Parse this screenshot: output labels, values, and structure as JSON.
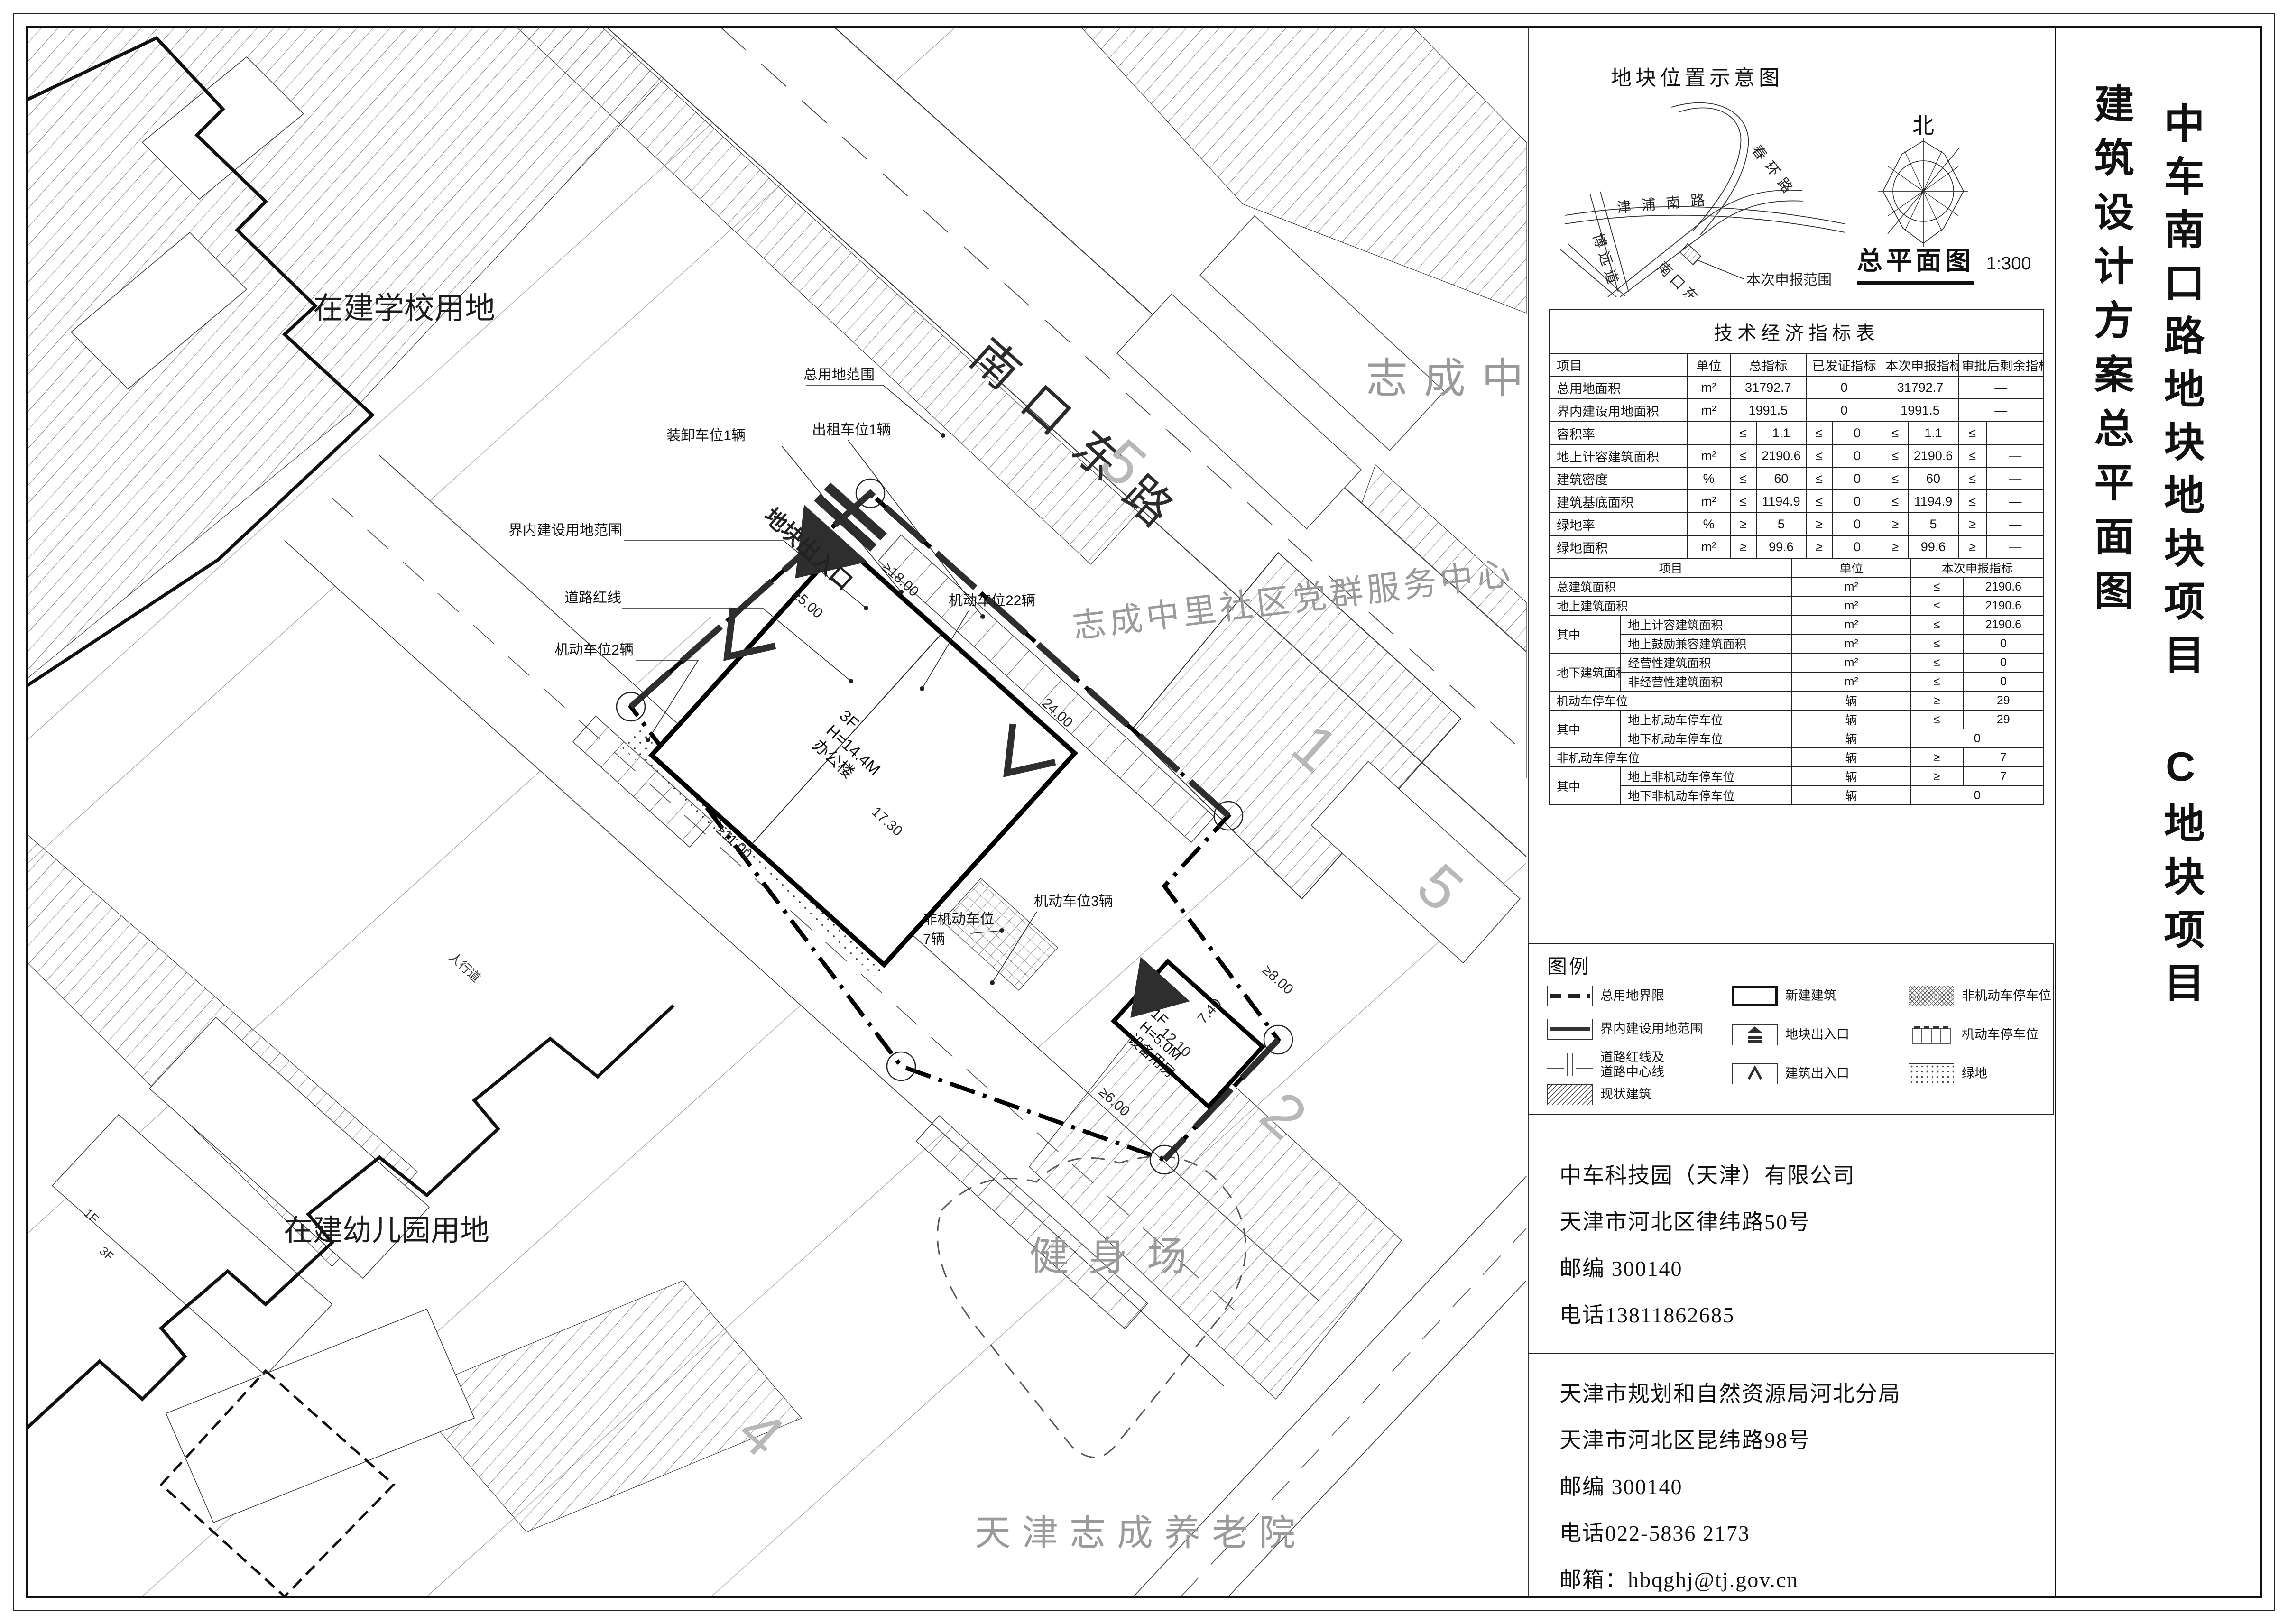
{
  "colors": {
    "line": "#1a1a1a",
    "gray_label": "#9a9a9a",
    "accent_dark": "#2e2e2e",
    "paper": "#ffffff"
  },
  "vertical_titles": {
    "project": "中车南口路地块地块项目 C地块项目",
    "drawing": "建筑设计方案总平面图"
  },
  "location_sketch": {
    "title": "地块位置示意图",
    "roads": [
      "春环路",
      "津浦南路",
      "博远道",
      "南口东路"
    ],
    "scope_label": "本次申报范围",
    "compass_north": "北",
    "plan_name": "总平面图",
    "plan_scale": "1:300"
  },
  "indicator_table": {
    "title": "技术经济指标表",
    "part1": {
      "header": [
        [
          "项目",
          1,
          1,
          "l h"
        ],
        [
          "单位"
        ],
        [
          "总指标",
          2
        ],
        [
          "已发证指标",
          2
        ],
        [
          "本次申报指标",
          2
        ],
        [
          "审批后剩余指标",
          2
        ]
      ],
      "rows": [
        [
          [
            "总用地面积",
            1,
            1,
            "l"
          ],
          [
            "m²"
          ],
          [
            "31792.7",
            2
          ],
          [
            "0",
            2
          ],
          [
            "31792.7",
            2
          ],
          [
            "—",
            2
          ]
        ],
        [
          [
            "界内建设用地面积",
            1,
            1,
            "l"
          ],
          [
            "m²"
          ],
          [
            "1991.5",
            2
          ],
          [
            "0",
            2
          ],
          [
            "1991.5",
            2
          ],
          [
            "—",
            2
          ]
        ],
        [
          [
            "容积率",
            1,
            1,
            "l"
          ],
          [
            "—"
          ],
          [
            "≤"
          ],
          [
            "1.1"
          ],
          [
            "≤"
          ],
          [
            "0"
          ],
          [
            "≤"
          ],
          [
            "1.1"
          ],
          [
            "≤"
          ],
          [
            "—"
          ]
        ],
        [
          [
            "地上计容建筑面积",
            1,
            1,
            "l"
          ],
          [
            "m²"
          ],
          [
            "≤"
          ],
          [
            "2190.6"
          ],
          [
            "≤"
          ],
          [
            "0"
          ],
          [
            "≤"
          ],
          [
            "2190.6"
          ],
          [
            "≤"
          ],
          [
            "—"
          ]
        ],
        [
          [
            "建筑密度",
            1,
            1,
            "l"
          ],
          [
            "%"
          ],
          [
            "≤"
          ],
          [
            "60"
          ],
          [
            "≤"
          ],
          [
            "0"
          ],
          [
            "≤"
          ],
          [
            "60"
          ],
          [
            "≤"
          ],
          [
            "—"
          ]
        ],
        [
          [
            "建筑基底面积",
            1,
            1,
            "l"
          ],
          [
            "m²"
          ],
          [
            "≤"
          ],
          [
            "1194.9"
          ],
          [
            "≤"
          ],
          [
            "0"
          ],
          [
            "≤"
          ],
          [
            "1194.9"
          ],
          [
            "≤"
          ],
          [
            "—"
          ]
        ],
        [
          [
            "绿地率",
            1,
            1,
            "l"
          ],
          [
            "%"
          ],
          [
            "≥"
          ],
          [
            "5"
          ],
          [
            "≥"
          ],
          [
            "0"
          ],
          [
            "≥"
          ],
          [
            "5"
          ],
          [
            "≥"
          ],
          [
            "—"
          ]
        ],
        [
          [
            "绿地面积",
            1,
            1,
            "l"
          ],
          [
            "m²"
          ],
          [
            "≥"
          ],
          [
            "99.6"
          ],
          [
            "≥"
          ],
          [
            "0"
          ],
          [
            "≥"
          ],
          [
            "99.6"
          ],
          [
            "≥"
          ],
          [
            "—"
          ]
        ]
      ]
    },
    "part2": {
      "header": [
        [
          "项目",
          2,
          1,
          "h"
        ],
        [
          "单位"
        ],
        [
          "本次申报指标",
          2
        ]
      ],
      "rows": [
        [
          [
            "总建筑面积",
            2,
            1,
            "l"
          ],
          [
            "m²"
          ],
          [
            "≤"
          ],
          [
            "2190.6"
          ]
        ],
        [
          [
            "地上建筑面积",
            2,
            1,
            "l"
          ],
          [
            "m²"
          ],
          [
            "≤"
          ],
          [
            "2190.6"
          ]
        ],
        [
          [
            "其中",
            1,
            2,
            "l"
          ],
          [
            "地上计容建筑面积",
            1,
            1,
            "l"
          ],
          [
            "m²"
          ],
          [
            "≤"
          ],
          [
            "2190.6"
          ]
        ],
        [
          [
            "地上鼓励兼容建筑面积",
            1,
            1,
            "l"
          ],
          [
            "m²"
          ],
          [
            "≤"
          ],
          [
            "0"
          ]
        ],
        [
          [
            "地下建筑面积",
            1,
            2,
            "l"
          ],
          [
            "经营性建筑面积",
            1,
            1,
            "l"
          ],
          [
            "m²"
          ],
          [
            "≤"
          ],
          [
            "0"
          ]
        ],
        [
          [
            "非经营性建筑面积",
            1,
            1,
            "l"
          ],
          [
            "m²"
          ],
          [
            "≤"
          ],
          [
            "0"
          ]
        ],
        [
          [
            "机动车停车位",
            2,
            1,
            "l"
          ],
          [
            "辆"
          ],
          [
            "≥"
          ],
          [
            "29"
          ]
        ],
        [
          [
            "其中",
            1,
            2,
            "l"
          ],
          [
            "地上机动车停车位",
            1,
            1,
            "l"
          ],
          [
            "辆"
          ],
          [
            "≤"
          ],
          [
            "29"
          ]
        ],
        [
          [
            "地下机动车停车位",
            1,
            1,
            "l"
          ],
          [
            "辆"
          ],
          [
            "0",
            2
          ]
        ],
        [
          [
            "非机动车停车位",
            2,
            1,
            "l"
          ],
          [
            "辆"
          ],
          [
            "≥"
          ],
          [
            "7"
          ]
        ],
        [
          [
            "其中",
            1,
            2,
            "l"
          ],
          [
            "地上非机动车停车位",
            1,
            1,
            "l"
          ],
          [
            "辆"
          ],
          [
            "≥"
          ],
          [
            "7"
          ]
        ],
        [
          [
            "地下非机动车停车位",
            1,
            1,
            "l"
          ],
          [
            "辆"
          ],
          [
            "0",
            2
          ]
        ]
      ]
    }
  },
  "legend": {
    "title": "图例",
    "items": [
      {
        "name": "总用地界限"
      },
      {
        "name": "界内建设用地范围"
      },
      {
        "name": "道路红线及道路中心线"
      },
      {
        "name": "现状建筑"
      },
      {
        "name": "新建建筑"
      },
      {
        "name": "地块出入口"
      },
      {
        "name": "建筑出入口"
      },
      {
        "name": "非机动车停车位"
      },
      {
        "name": "机动车停车位"
      },
      {
        "name": "绿地"
      }
    ]
  },
  "contact_blocks": [
    {
      "lines": [
        "中车科技园（天津）有限公司",
        "天津市河北区律纬路50号",
        "邮编  300140",
        "电话13811862685"
      ]
    },
    {
      "lines": [
        "天津市规划和自然资源局河北分局",
        "天津市河北区昆纬路98号",
        "邮编  300140",
        "电话022-5836  2173",
        "邮箱：hbqghj@tj.gov.cn"
      ]
    }
  ],
  "site_plan": {
    "areas": {
      "school": "在建学校用地",
      "kindergarten": "在建幼儿园用地",
      "zhicheng_zhongli": "志成中里",
      "party_center": "志成中里社区党群服务中心",
      "fitness": "健身场",
      "nursing_home": "天津志成养老院",
      "road_name": "南口东路",
      "sidewalk": "人行道"
    },
    "callouts": {
      "total_site_scope": "总用地范围",
      "inner_construction_scope": "界内建设用地范围",
      "road_red_line": "道路红线",
      "parking_2": "机动车位2辆",
      "loading_1": "装卸车位1辆",
      "taxi_1": "出租车位1辆",
      "parking_22": "机动车位22辆",
      "parking_3": "机动车位3辆",
      "non_motor_line1": "非机动车位",
      "non_motor_line2": "7辆",
      "site_entrance": "地块出入口"
    },
    "dimensions": {
      "d1": "≥5.00",
      "d2": "≥18.00",
      "d3": "24.00",
      "d4": "17.30",
      "d5": "≥11.00",
      "d6": "≥6.00",
      "d7": "≥8.00",
      "d8": "12.10",
      "d9": "7.40"
    },
    "buildings": {
      "office": {
        "floors": "3F",
        "height": "H=14.4M",
        "name": "办公楼"
      },
      "equipment": {
        "floors": "1F",
        "height": "H=5.0M",
        "name": "设备用房"
      }
    },
    "block_numbers": {
      "n1": "1",
      "n2": "2",
      "n4": "4",
      "n5a": "5",
      "n5b": "5"
    },
    "floor_tags": {
      "f1": "1F",
      "f3": "3F"
    }
  }
}
